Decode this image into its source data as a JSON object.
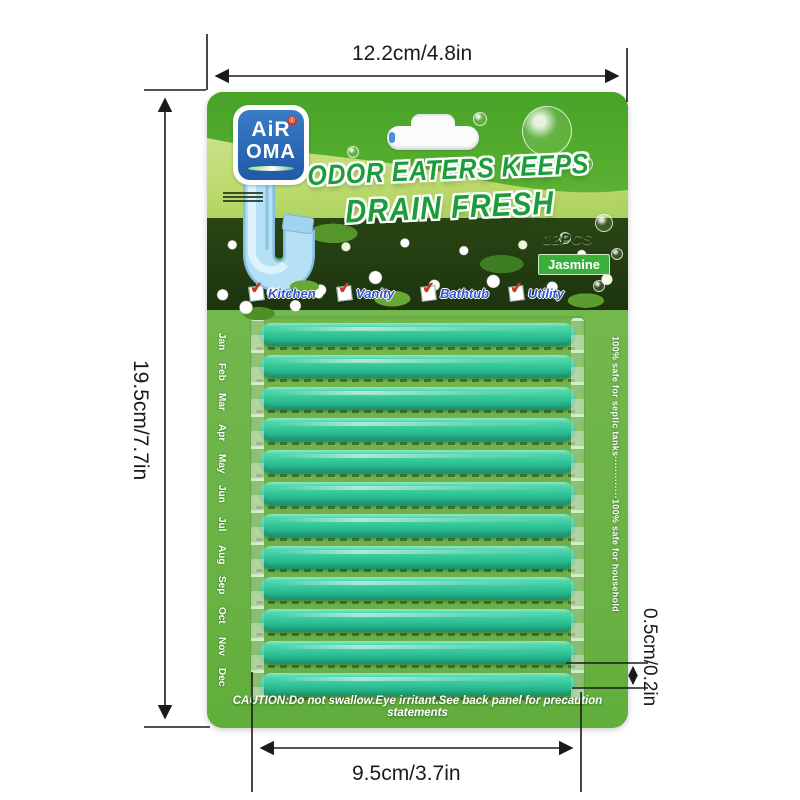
{
  "annotations": {
    "width_label": "12.2cm/4.8in",
    "height_label": "19.5cm/7.7in",
    "inner_width_label": "9.5cm/3.7in",
    "thickness_label": "0.5cm/0.2in"
  },
  "package": {
    "logo": {
      "line1": "AiR",
      "line2": "OMA",
      "registered": "®"
    },
    "title_line1": "ODOR EATERS KEEPS",
    "title_line2": "DRAIN FRESH",
    "count_label": "12PCS",
    "scent_badge": "Jasmine",
    "check_glyph": "✔",
    "usage_options": [
      "Kitchen",
      "Vanity",
      "Bathtub",
      "Utility"
    ],
    "months": [
      "Jan",
      "Feb",
      "Mar",
      "Apr",
      "May",
      "Jun",
      "Jul",
      "Aug",
      "Sep",
      "Oct",
      "Nov",
      "Dec"
    ],
    "side_note_left": "100% safe for septic tanks",
    "side_note_dots": "·············",
    "side_note_right": "100% safe for household",
    "caution_text": "CAUTION:Do not swallow.Eye irritant.See back panel for precaution statements",
    "sticks_count": 12
  },
  "colors": {
    "card_green": "#6FB449",
    "header_green": "#4CA62A",
    "stick_teal": "#36C89B",
    "logo_blue": "#2563B2",
    "option_blue": "#2F55D4",
    "check_red": "#C8371F",
    "badge_green": "#3BAE3C",
    "title_green": "#1C9C3A",
    "dimension_line": "#1A1A1A"
  }
}
